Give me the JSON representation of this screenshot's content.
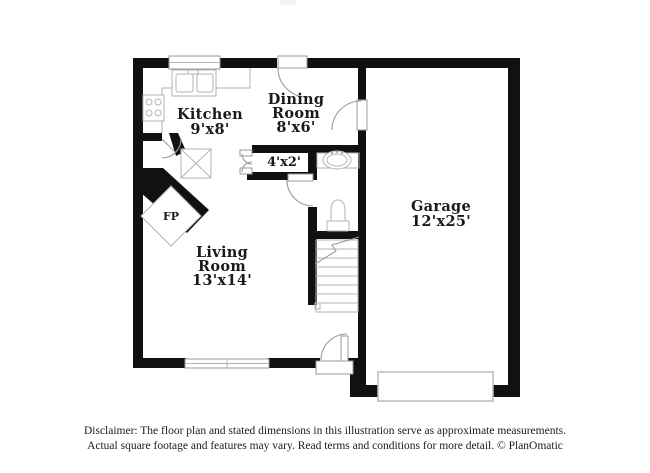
{
  "colors": {
    "wall": "#111111",
    "fixture_line": "#b3b3b3",
    "door_line": "#9a9a9a",
    "label_text": "#1a1a1a",
    "background": "#ffffff"
  },
  "floor_plan": {
    "rooms": [
      {
        "id": "kitchen",
        "name": "Kitchen",
        "dims": "9'x8'"
      },
      {
        "id": "dining-room",
        "name": "Dining Room",
        "name_lines": [
          "Dining",
          "Room"
        ],
        "dims": "8'x6'"
      },
      {
        "id": "closet",
        "name": "Closet",
        "dims": "4'x2'"
      },
      {
        "id": "living-room",
        "name": "Living Room",
        "name_lines": [
          "Living",
          "Room"
        ],
        "dims": "13'x14'"
      },
      {
        "id": "garage",
        "name": "Garage",
        "dims": "12'x25'"
      }
    ],
    "fireplace": {
      "label": "FP"
    },
    "fixtures": [
      "kitchen-sink",
      "stove",
      "kitchen-window",
      "x-marked-cabinet",
      "fireplace",
      "bathroom-sink",
      "toilet",
      "staircase",
      "living-room-window",
      "front-door",
      "garage-overhead-door",
      "dining-entry-door",
      "garage-entry-door",
      "bathroom-door",
      "kitchen-door",
      "closet-double-doors"
    ]
  },
  "footer": {
    "disclaimer_line1": "Disclaimer: The floor plan and stated dimensions in this illustration serve as approximate measurements.",
    "disclaimer_line2": "Actual square footage and features may vary. Read terms and conditions for more detail. © PlanOmatic"
  }
}
